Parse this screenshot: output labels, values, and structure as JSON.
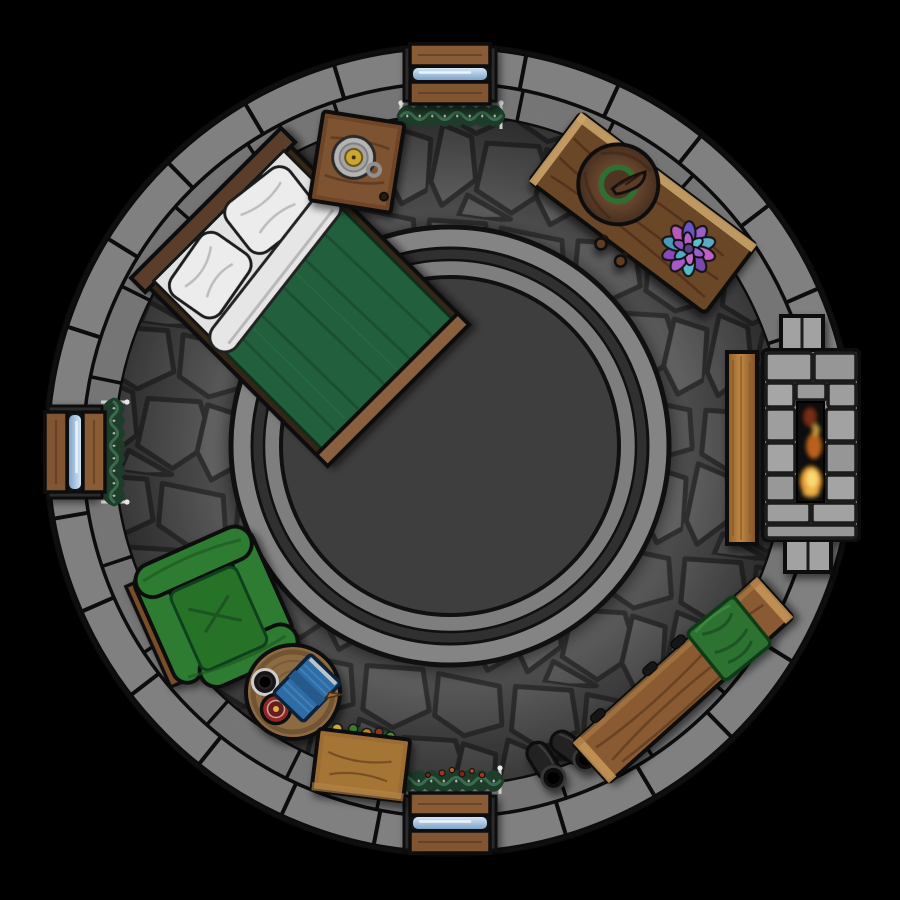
{
  "meta": {
    "title": "Top-down fantasy battle map — circular stone tower bedroom",
    "background": "#000000"
  },
  "scene": {
    "center": {
      "x": 450,
      "y": 450
    },
    "wall": {
      "outer_radius": 403,
      "mid_radius": 367,
      "inner_radius": 334,
      "outer_color": "#9a9a9a",
      "inner_color": "#8c8c8c",
      "mortar": "#0f0f0f",
      "outer_blocks": 26,
      "inner_blocks": 24
    },
    "floor": {
      "base": "#5f5f5f",
      "stone_shades": [
        "#747474",
        "#6d6d6d",
        "#787878",
        "#707070",
        "#7a7a7a"
      ],
      "line": "#3c3c3c"
    },
    "rug": {
      "cx": 450,
      "cy": 446,
      "outline": "#141414",
      "rings": [
        {
          "r": 219,
          "fill": "#9e9e9e",
          "ow": 5
        },
        {
          "r": 198,
          "fill": "#3a3a3a",
          "ow": 3
        },
        {
          "r": 186,
          "fill": "#979797",
          "ow": 2.5
        },
        {
          "r": 169,
          "fill": "#4b4b4b",
          "ow": 4
        }
      ]
    },
    "noise_opacity": 0.16
  },
  "windows": {
    "frame_wood": "#8a5c36",
    "jamb_stone": "#2b2b2b",
    "glass_light": "#d6e7f6",
    "glass_dark": "#7fa3c8",
    "instances": [
      {
        "id": "top",
        "x": 450,
        "y": 74,
        "rot": 0
      },
      {
        "id": "left",
        "x": 75,
        "y": 452,
        "rot": 90
      },
      {
        "id": "bottom",
        "x": 450,
        "y": 823,
        "rot": 0
      }
    ]
  },
  "garlands": {
    "len": 100,
    "amp": 13,
    "waves": 8,
    "color": "#1d3c29",
    "highlight": "#3e7050",
    "rod": "#b5b5b5",
    "pin": "#d0d0d0",
    "instances": [
      {
        "id": "top",
        "x": 451,
        "y": 116,
        "rot": 0
      },
      {
        "id": "left",
        "x": 114,
        "y": 452,
        "rot": 90
      },
      {
        "id": "bottom",
        "x": 450,
        "y": 781,
        "rot": 0
      }
    ],
    "berries_on": 2,
    "berries": [
      {
        "x": -22,
        "y": -6,
        "r": 2.4,
        "c": "#7c2a16"
      },
      {
        "x": -8,
        "y": -8,
        "r": 3,
        "c": "#a83220"
      },
      {
        "x": 2,
        "y": -11,
        "r": 2.6,
        "c": "#c25a22"
      },
      {
        "x": 12,
        "y": -7,
        "r": 3,
        "c": "#8a2014"
      },
      {
        "x": 22,
        "y": -10,
        "r": 2.4,
        "c": "#b24a26"
      },
      {
        "x": 32,
        "y": -6,
        "r": 2.8,
        "c": "#a83220"
      }
    ]
  },
  "furniture": {
    "bed": {
      "blanket": "#205f3c",
      "blanket_streak": "#17482c",
      "pillow": "#ececec",
      "sheet": "#e6e6e6",
      "headboard": "#5a3e2a",
      "footboard": "#8a5f3c",
      "rails": "#352619"
    },
    "nightstand": {
      "body": "#6e4526",
      "top": "#7e5230",
      "plate": "#b4b4b4",
      "candle": "#caa733"
    },
    "desk": {
      "wood": "#6b4628",
      "light_edge": "#c9a268",
      "knob": "#5e3c22"
    },
    "witch_hat": {
      "brim": "#64432c",
      "band": "#2f7030",
      "tip": "#5a3c28"
    },
    "succulent": {
      "outer": [
        "#9a5ec8",
        "#5aaac8",
        "#c05ec8",
        "#7a48b0",
        "#58b8c8",
        "#a858c8",
        "#8a4ab8",
        "#4a9ab8",
        "#b858b8",
        "#6a54c0"
      ],
      "inner": [
        "#58c0c8",
        "#9a5ec8",
        "#c06ac8",
        "#50aac0",
        "#8a54bc",
        "#b860c0"
      ],
      "core": "#5a3f86"
    },
    "fireplace": {
      "stone": "#9e9e9e",
      "firebox": "#0a0a0a",
      "plank_wood": "#b5803f"
    },
    "flames": [
      {
        "cx": 811,
        "cy": 481,
        "rx": 11,
        "ry": 15,
        "fill": "#e89a30",
        "op": 1
      },
      {
        "cx": 812,
        "cy": 479,
        "rx": 6,
        "ry": 9,
        "fill": "#f8da72",
        "op": 1
      },
      {
        "cx": 814,
        "cy": 446,
        "rx": 8,
        "ry": 13,
        "fill": "#c2661f",
        "op": 0.95
      },
      {
        "cx": 810,
        "cy": 417,
        "rx": 7,
        "ry": 10,
        "fill": "#7e3014",
        "op": 0.9
      },
      {
        "cx": 816,
        "cy": 430,
        "rx": 4,
        "ry": 6,
        "fill": "#e8b84a",
        "op": 0.8
      },
      {
        "cx": 811,
        "cy": 493,
        "rx": 9,
        "ry": 5,
        "fill": "#f6c050",
        "op": 0.6
      }
    ],
    "armchair": {
      "green": "#2e7c30",
      "seat": "#287228",
      "shadow": "#1d5522",
      "wood": "#7a4e2a"
    },
    "side_table": {
      "wood": "#8c6a42",
      "rim": "#6c4e2e"
    },
    "book": {
      "cover": "#2f6ca6",
      "spine": "#255a8c",
      "pages": "#b8c4cc",
      "quill": "#a06a30"
    },
    "mug": {
      "body": "#171212",
      "rim": "#cdcdcd"
    },
    "candle_dish": {
      "outer": "#93282a",
      "inner": "#6a1a1a",
      "center": "#d8b050"
    },
    "chest": {
      "wood": "#9c6c34",
      "face": "#a87838"
    },
    "boots": {
      "body": "#212121",
      "opening": "#0b0b0b"
    },
    "bench": {
      "wood": "#8a5a30",
      "end_caps": "#c89858",
      "cushion": "#2d7233"
    }
  },
  "boots_instances": [
    {
      "x": 546,
      "y": 766,
      "rot": 58
    },
    {
      "x": 574,
      "y": 751,
      "rot": 36
    }
  ],
  "objects_inventory": [
    {
      "name": "bed",
      "desc": "Double bed with green blanket, white sheet fold and two white pillows, wooden head/foot boards",
      "position": "upper-left, rotated 45 degrees"
    },
    {
      "name": "nightstand",
      "desc": "Wooden nightstand holding a chamberstick candle on a metal plate",
      "position": "top, beside bed head"
    },
    {
      "name": "desk",
      "desc": "Wooden table with brown witch hat (green band) and a purple-teal succulent",
      "position": "upper-right along wall"
    },
    {
      "name": "fireplace",
      "desc": "Stone masonry fireplace with burning fire, wooden plank bench in front",
      "position": "right, set into wall"
    },
    {
      "name": "armchair",
      "desc": "Green upholstered armchair with wooden frame plank",
      "position": "lower-left"
    },
    {
      "name": "side-table",
      "desc": "Round wooden table with closed blue book and quill, dark mug, red candle dish",
      "position": "bottom-left of center"
    },
    {
      "name": "storage-chest",
      "desc": "Wooden chest with green herbs and yellow yarn peeking out",
      "position": "bottom"
    },
    {
      "name": "bench",
      "desc": "Long curved wooden bench with a green cushion",
      "position": "lower-right along wall"
    },
    {
      "name": "boots",
      "desc": "Pair of black boots",
      "position": "bottom, between chest and bench"
    },
    {
      "name": "windows",
      "desc": "Three wood-framed slit windows with pale blue glass",
      "position": "top, left and bottom of wall ring"
    },
    {
      "name": "garlands",
      "desc": "Dark green vine garlands hung on metal rods, bottom one with red berries",
      "position": "inner wall at each window"
    },
    {
      "name": "rug",
      "desc": "Large round dark gray rug with two light concentric bands",
      "position": "room center"
    }
  ]
}
